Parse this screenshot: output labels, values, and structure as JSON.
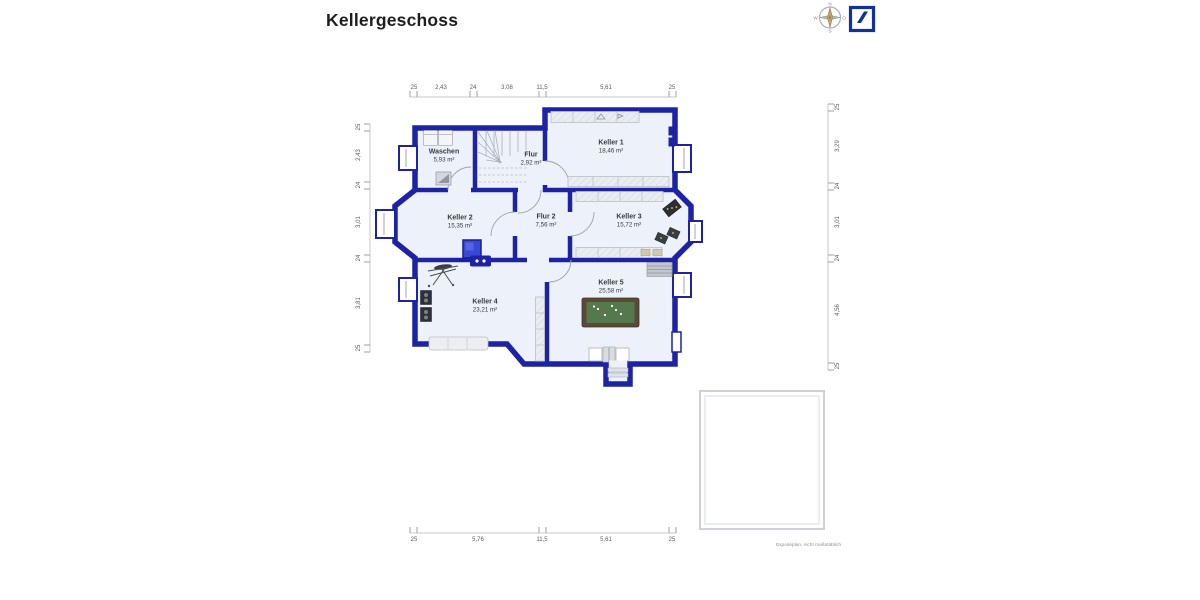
{
  "title": "Kellergeschoss",
  "footnote": "Exposéplan, nicht maßstäblich",
  "compass": {
    "north": "N",
    "east": "O",
    "south": "S",
    "west": "W"
  },
  "icons": {
    "compass": "compass-rose",
    "brand": "deutsche-bank-logo"
  },
  "rooms": [
    {
      "name": "Waschen",
      "area": "5,93 m²"
    },
    {
      "name": "Flur",
      "area": "2,92 m²"
    },
    {
      "name": "Keller 1",
      "area": "18,46 m²"
    },
    {
      "name": "Keller 2",
      "area": "15,35 m²"
    },
    {
      "name": "Flur 2",
      "area": "7,56 m²"
    },
    {
      "name": "Keller 3",
      "area": "15,72 m²"
    },
    {
      "name": "Keller 4",
      "area": "23,21 m²"
    },
    {
      "name": "Keller 5",
      "area": "25,58 m²"
    }
  ],
  "dimensions": {
    "top": [
      "25",
      "2,43",
      "24",
      "3,08",
      "11,5",
      "5,61",
      "25"
    ],
    "bottom": [
      "25",
      "5,76",
      "11,5",
      "5,61",
      "25"
    ],
    "left": [
      "25",
      "2,43",
      "24",
      "3,01",
      "24",
      "3,81",
      "25"
    ],
    "right": [
      "25",
      "3,29",
      "24",
      "3,01",
      "24",
      "4,56",
      "25"
    ]
  },
  "colors": {
    "wall": "#1d23a3",
    "floor": "#edf1f9",
    "brand_blue": "#10329c",
    "accent_box": "#3849d6",
    "pool_felt": "#55784d"
  }
}
